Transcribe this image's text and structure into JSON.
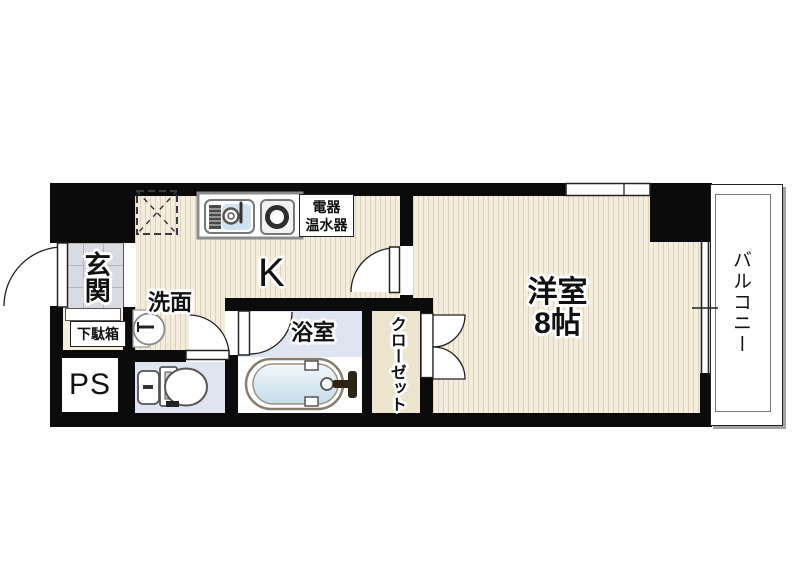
{
  "plan_title": "1K apartment floor plan",
  "rooms": {
    "entrance": {
      "label": "玄関"
    },
    "shoe_box": {
      "label": "下駄箱"
    },
    "pipe_space": {
      "label": "PS"
    },
    "washroom": {
      "label": "洗面"
    },
    "kitchen": {
      "label": "K"
    },
    "water_heater": {
      "line1": "電器",
      "line2": "温水器"
    },
    "bathroom": {
      "label": "浴室"
    },
    "closet": {
      "label": "クローゼット"
    },
    "western_room": {
      "name": "洋室",
      "size": "8帖"
    },
    "balcony": {
      "label": "バルコニー"
    }
  },
  "colors": {
    "wall": "#0b0b0b",
    "wood_floor": "#f4edde",
    "entrance_tile": "#dadae1",
    "wet_area_floor": "#dfe4f1",
    "closet_floor": "#ece4cf",
    "tub_water": "#c6dce9"
  }
}
